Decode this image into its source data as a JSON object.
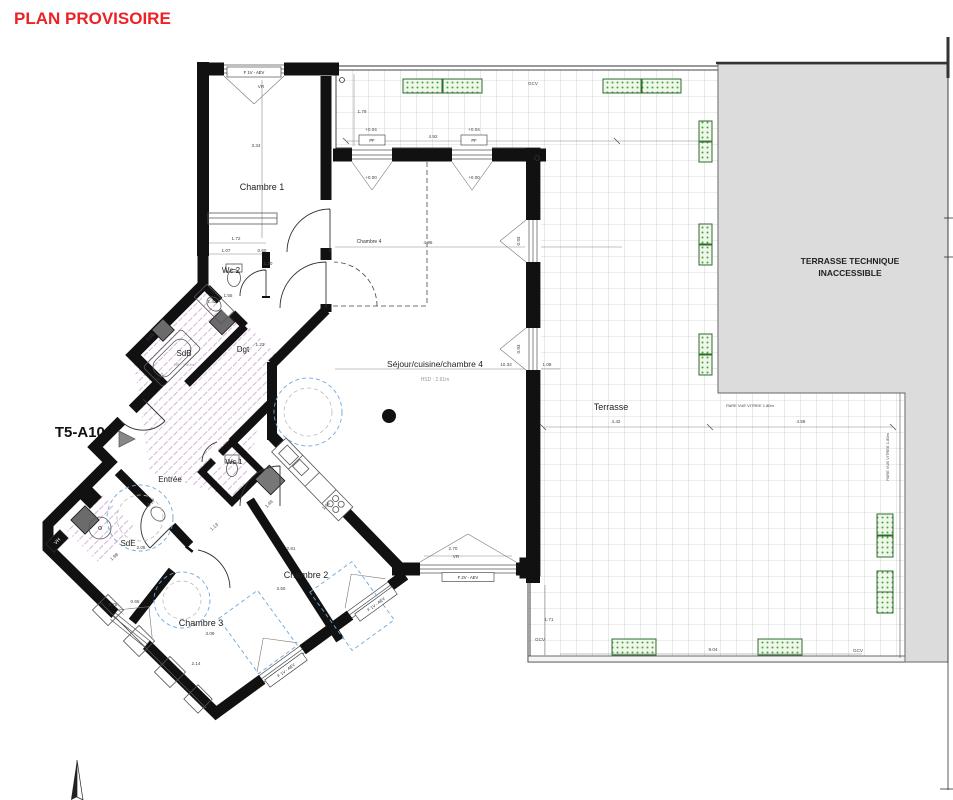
{
  "title": {
    "text": "PLAN PROVISOIRE"
  },
  "unit_label": {
    "text": "T5-A102"
  },
  "colors": {
    "title_red": "#ec2227",
    "wall_black": "#111111",
    "terrace_technique_gray": "#dcdcdc",
    "planter_green": "#49a23c",
    "tile_hatch_pink": "#c98fcb",
    "accessibility_blue": "#6fa8dc"
  },
  "labels": [
    {
      "t": "Chambre 1",
      "x": 262,
      "y": 190,
      "fs": 9,
      "c": "#222"
    },
    {
      "t": "Wc 2",
      "x": 231,
      "y": 273,
      "fs": 8,
      "c": "#222"
    },
    {
      "t": "SdB",
      "x": 184,
      "y": 356,
      "fs": 8,
      "c": "#222"
    },
    {
      "t": "HP : 2.50m",
      "x": 184,
      "y": 366,
      "fs": 4,
      "c": "#b08ab0"
    },
    {
      "t": "Dgt",
      "x": 243,
      "y": 352,
      "fs": 8,
      "c": "#222"
    },
    {
      "t": "1.22",
      "x": 260,
      "y": 346
    },
    {
      "t": "Entrée",
      "x": 170,
      "y": 482,
      "fs": 8,
      "c": "#222"
    },
    {
      "t": "Wc 1",
      "x": 234,
      "y": 464,
      "fs": 7.5,
      "c": "#222"
    },
    {
      "t": "SdE",
      "x": 128,
      "y": 546,
      "fs": 8,
      "c": "#222"
    },
    {
      "t": "Chambre 2",
      "x": 306,
      "y": 578,
      "fs": 9,
      "c": "#222"
    },
    {
      "t": "Chambre 3",
      "x": 201,
      "y": 626,
      "fs": 9,
      "c": "#222"
    },
    {
      "t": "Séjour/cuisine/chambre 4",
      "x": 435,
      "y": 367,
      "fs": 8.5,
      "c": "#222"
    },
    {
      "t": "HSD : 2.61m",
      "x": 435,
      "y": 381,
      "fs": 5,
      "c": "#9a9a9a"
    },
    {
      "t": "Chambre 4",
      "x": 369,
      "y": 243,
      "fs": 5,
      "c": "#333"
    },
    {
      "t": "Terrasse",
      "x": 611,
      "y": 410,
      "fs": 9,
      "c": "#222"
    },
    {
      "t": "TERRASSE TECHNIQUE",
      "x": 850,
      "y": 264,
      "fs": 8.5,
      "b": 1,
      "c": "#222"
    },
    {
      "t": "INACCESSIBLE",
      "x": 850,
      "y": 276,
      "fs": 8.5,
      "b": 1,
      "c": "#222"
    },
    {
      "t": "3.34",
      "x": 256,
      "y": 147
    },
    {
      "t": "1.72",
      "x": 236,
      "y": 240
    },
    {
      "t": "1.07",
      "x": 226,
      "y": 252
    },
    {
      "t": "0.60",
      "x": 262,
      "y": 252
    },
    {
      "t": "1.30",
      "x": 268,
      "y": 265
    },
    {
      "t": "1.55",
      "x": 228,
      "y": 297
    },
    {
      "t": "1.42",
      "x": 212,
      "y": 303
    },
    {
      "t": "3.15",
      "x": 151,
      "y": 338,
      "r": -45
    },
    {
      "t": "1.72",
      "x": 161,
      "y": 378,
      "r": -45
    },
    {
      "t": "2.17",
      "x": 152,
      "y": 504,
      "r": -40
    },
    {
      "t": "2.05",
      "x": 141,
      "y": 549
    },
    {
      "t": "1.98",
      "x": 115,
      "y": 558,
      "r": -40
    },
    {
      "t": "0.78",
      "x": 113,
      "y": 606
    },
    {
      "t": "0.65",
      "x": 135,
      "y": 603
    },
    {
      "t": "1.13",
      "x": 215,
      "y": 528,
      "r": -40
    },
    {
      "t": "1.48",
      "x": 270,
      "y": 505,
      "r": -45
    },
    {
      "t": "1.48",
      "x": 327,
      "y": 507,
      "r": -45
    },
    {
      "t": "2.81",
      "x": 291,
      "y": 550
    },
    {
      "t": "3.50",
      "x": 281,
      "y": 590
    },
    {
      "t": "3.09",
      "x": 210,
      "y": 635
    },
    {
      "t": "2.14",
      "x": 196,
      "y": 665
    },
    {
      "t": "1.79",
      "x": 362,
      "y": 113
    },
    {
      "t": "4.92",
      "x": 433,
      "y": 138
    },
    {
      "t": "+0.04",
      "x": 371,
      "y": 131
    },
    {
      "t": "+0.00",
      "x": 371,
      "y": 179
    },
    {
      "t": "+0.04",
      "x": 474,
      "y": 131
    },
    {
      "t": "+0.00",
      "x": 474,
      "y": 179
    },
    {
      "t": "10.32",
      "x": 506,
      "y": 366
    },
    {
      "t": "1.08",
      "x": 547,
      "y": 366
    },
    {
      "t": "4.95",
      "x": 428,
      "y": 244
    },
    {
      "t": "4.42",
      "x": 616,
      "y": 423
    },
    {
      "t": "4.58",
      "x": 801,
      "y": 423
    },
    {
      "t": "1.71",
      "x": 549,
      "y": 621
    },
    {
      "t": "9.04",
      "x": 713,
      "y": 651
    },
    {
      "t": "2.70",
      "x": 453,
      "y": 550
    },
    {
      "t": "0.93",
      "x": 520,
      "y": 241,
      "r": -90
    },
    {
      "t": "0.93",
      "x": 520,
      "y": 349,
      "r": -90
    },
    {
      "t": "VR",
      "x": 261,
      "y": 88
    },
    {
      "t": "VR",
      "x": 456,
      "y": 558
    },
    {
      "t": "GCV",
      "x": 533,
      "y": 85
    },
    {
      "t": "GCV",
      "x": 540,
      "y": 641
    },
    {
      "t": "GCV",
      "x": 858,
      "y": 652
    },
    {
      "t": "PARE VUE VITREE 1.80m",
      "x": 750,
      "y": 407,
      "fs": 4
    },
    {
      "t": "PARE VUE VITREE 1.80m",
      "x": 889,
      "y": 457,
      "r": -90,
      "fs": 4
    }
  ],
  "boxed_labels": [
    {
      "t": "F 1V - AEV",
      "x": 254,
      "y": 72,
      "w": 54,
      "h": 10
    },
    {
      "t": "PF",
      "x": 372,
      "y": 140,
      "w": 26,
      "h": 10
    },
    {
      "t": "PF",
      "x": 474,
      "y": 140,
      "w": 26,
      "h": 10
    },
    {
      "t": "F 2V - AEV",
      "x": 468,
      "y": 577,
      "w": 52,
      "h": 9
    },
    {
      "t": "F 1V - AEV",
      "x": 376,
      "y": 604,
      "w": 46,
      "h": 9,
      "r": -36
    },
    {
      "t": "F 1V - AEV",
      "x": 286,
      "y": 670,
      "w": 46,
      "h": 9,
      "r": -36
    },
    {
      "t": "VH",
      "x": 57,
      "y": 541,
      "w": 20,
      "h": 12,
      "r": -45,
      "inv": 1
    }
  ]
}
